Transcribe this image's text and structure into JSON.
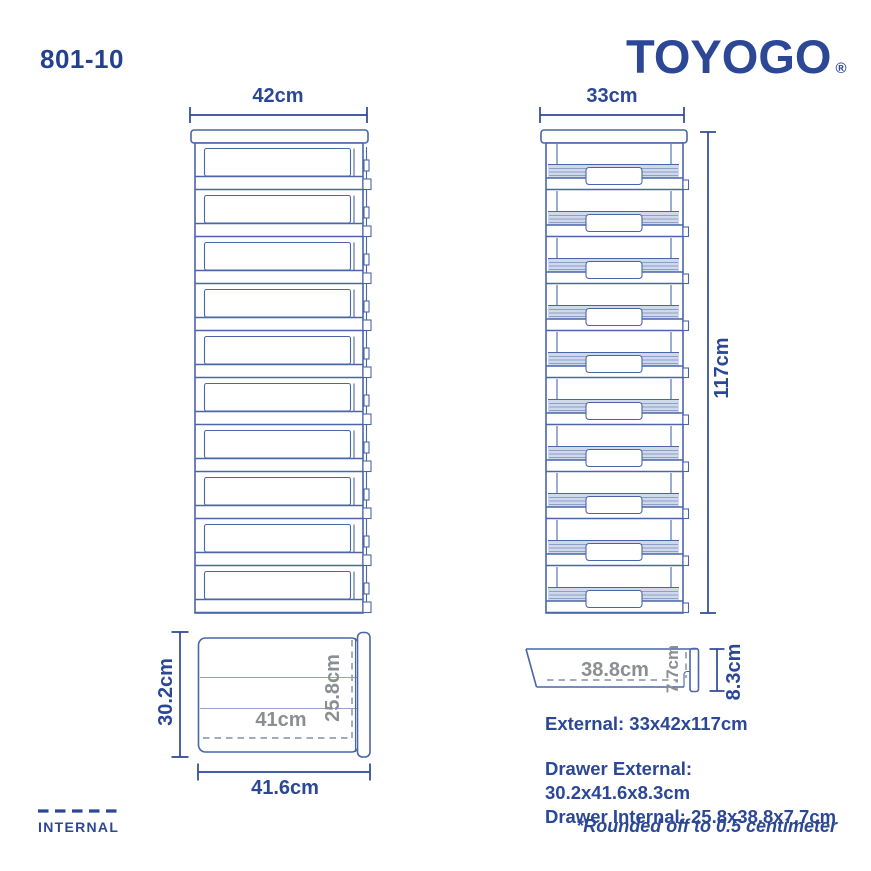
{
  "header": {
    "model_number": "801-10",
    "brand": "TOYOGO",
    "registered_mark": "®"
  },
  "front_view": {
    "drawer_count": 10,
    "width_label": "42cm"
  },
  "side_view": {
    "drawer_count": 10,
    "depth_label": "33cm",
    "height_label": "117cm"
  },
  "drawer_top_view": {
    "external_depth_label": "30.2cm",
    "internal_width_label": "41cm",
    "internal_depth_label": "25.8cm",
    "external_width_label": "41.6cm"
  },
  "drawer_side_view": {
    "internal_length_label": "38.8cm",
    "internal_height_label": "7.7cm",
    "external_height_label": "8.3cm"
  },
  "specs": {
    "external": "External: 33x42x117cm",
    "drawer_external": "Drawer External: 30.2x41.6x8.3cm",
    "drawer_internal": "Drawer Internal: 25.8x38.8x7.7cm"
  },
  "footnote": "*Rounded off to 0.5 centimeter",
  "legend": {
    "internal_label": "INTERNAL"
  },
  "colors": {
    "navy": "#2b4796",
    "drawing_line": "#4a66a8",
    "gray_label": "#8b8e93",
    "hatch_fill": "#cfd9ea"
  }
}
